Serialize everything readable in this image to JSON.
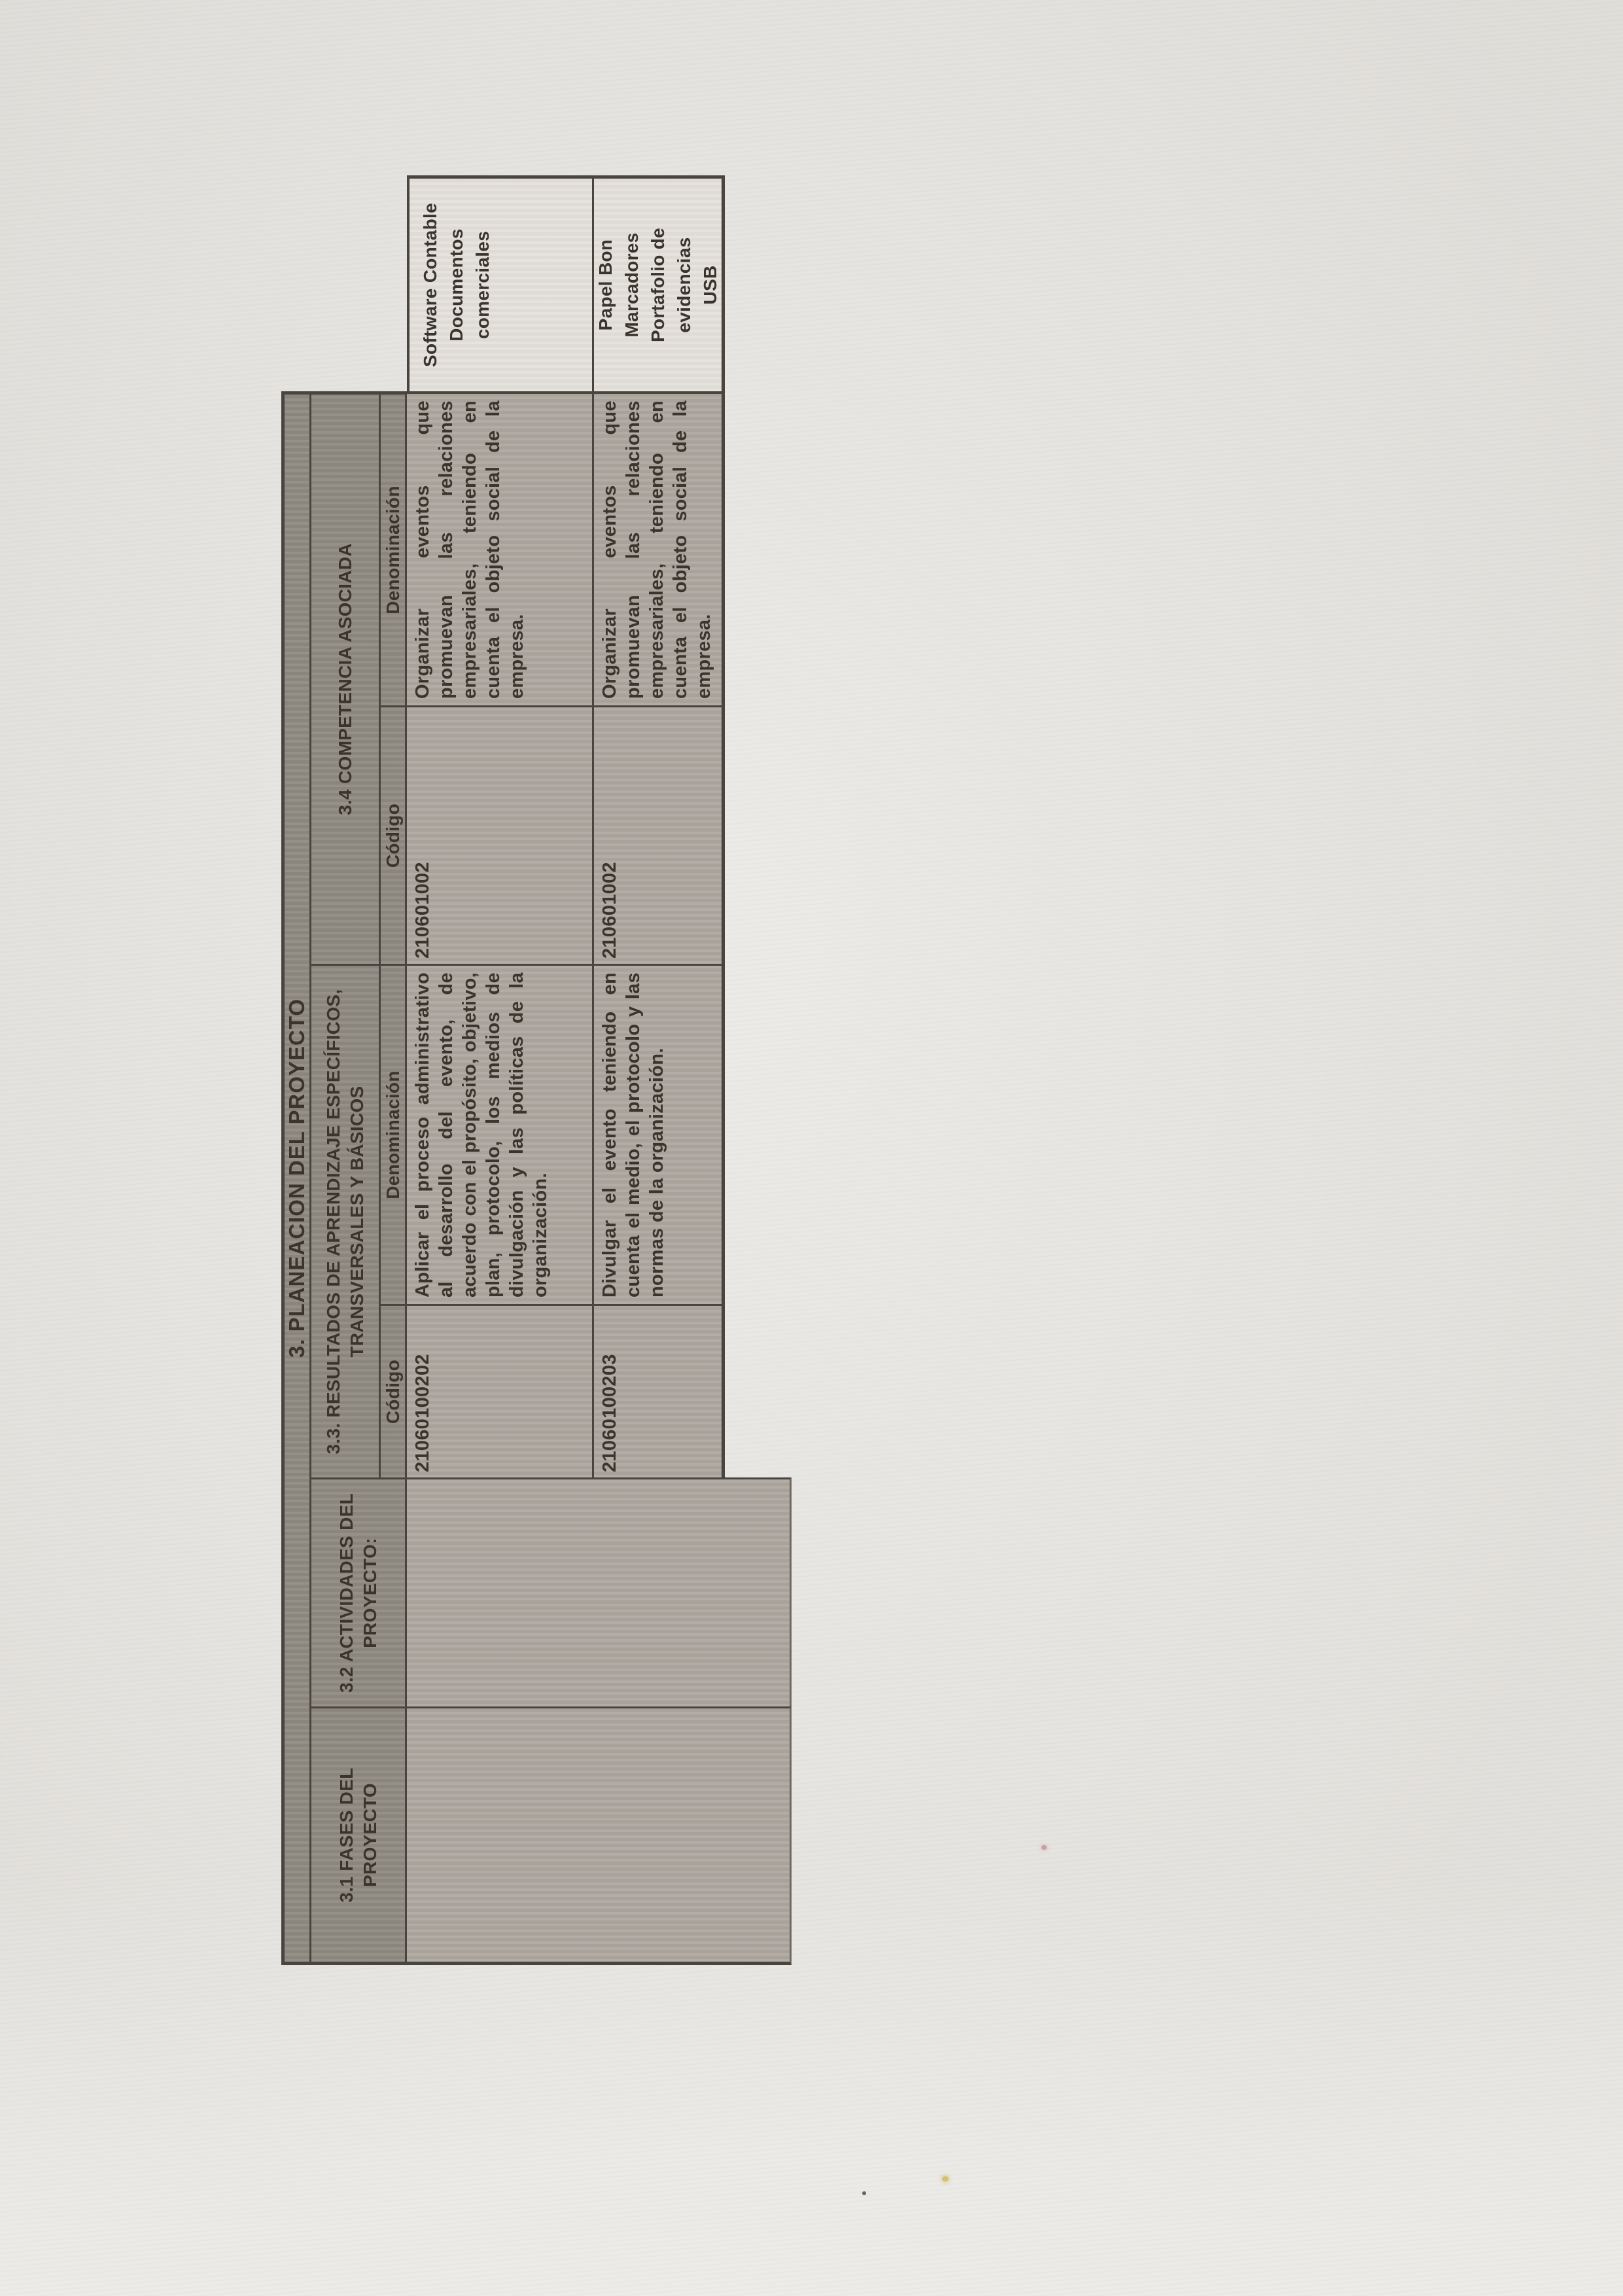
{
  "document": {
    "banner": "3. PLANEACION DEL PROYECTO",
    "headers": {
      "fases": "3.1 FASES DEL PROYECTO",
      "actividades": "3.2 ACTIVIDADES DEL PROYECTO:",
      "resultados": "3.3. RESULTADOS DE APRENDIZAJE ESPECÍFICOS, TRANSVERSALES Y BÁSICOS",
      "competencia": "3.4 COMPETENCIA ASOCIADA",
      "codigo": "Código",
      "denominacion": "Denominación"
    },
    "rows": [
      {
        "codigo_resultado": "21060100202",
        "denominacion_resultado": "Aplicar el proceso administrativo al desarrollo del evento, de acuerdo con el propósito, objetivo, plan, protocolo, los medios de divulgación y las políticas de la organización.",
        "codigo_competencia": "210601002",
        "denominacion_competencia": "Organizar eventos que promuevan las relaciones empresariales, teniendo en cuenta el objeto social de la empresa.",
        "materiales": "Software Contable\nDocumentos comerciales"
      },
      {
        "codigo_resultado": "21060100203",
        "denominacion_resultado": "Divulgar el evento teniendo en cuenta el medio, el protocolo y las normas de la organización.",
        "codigo_competencia": "210601002",
        "denominacion_competencia": "Organizar eventos que promuevan las relaciones empresariales, teniendo en cuenta el objeto social de la empresa.",
        "materiales": "Papel Bon\nMarcadores\nPortafolio de evidencias\nUSB"
      }
    ]
  },
  "colors": {
    "paper": "#e9e7e3",
    "cell_shade": "#aca79f",
    "band_shade": "#8f8a82",
    "materials_bg": "#e4e1db",
    "line": "#4a443e",
    "ink": "#3a342d"
  }
}
